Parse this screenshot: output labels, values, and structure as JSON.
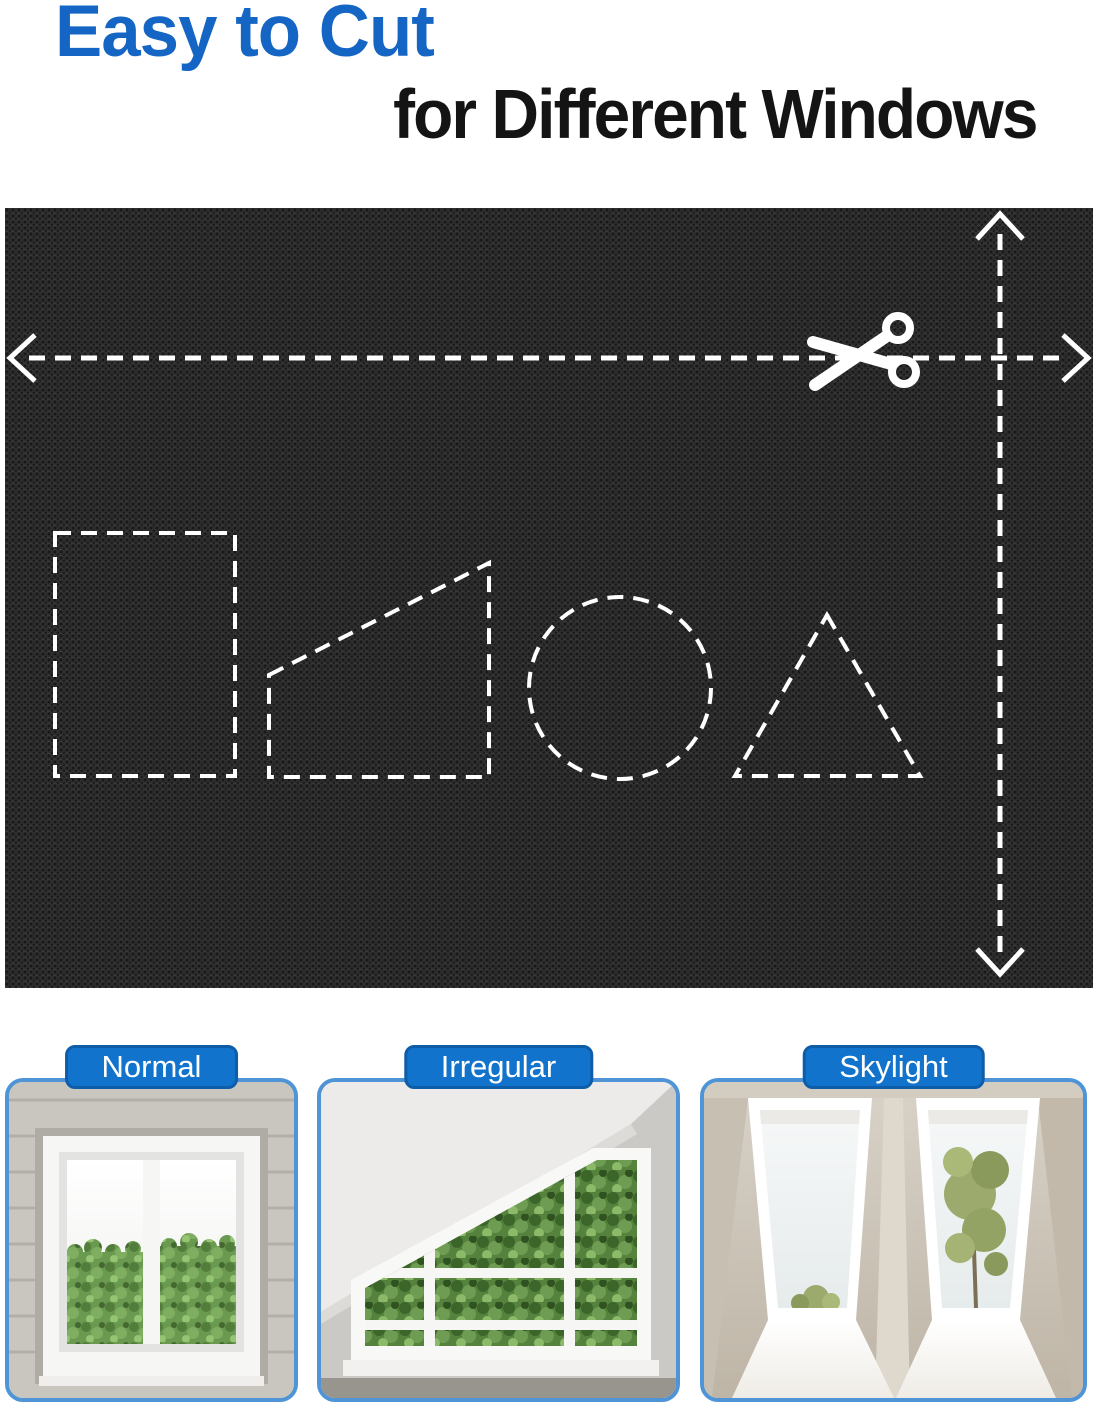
{
  "title": {
    "line1": "Easy to Cut",
    "line2": "for Different Windows"
  },
  "colors": {
    "title_blue": "#1566c4",
    "title_black": "#141414",
    "badge_blue": "#1273cd",
    "badge_border_blue": "#0d5da9",
    "card_border_blue": "#4e94d6",
    "fabric_dark": "#2e2e2e",
    "guide_white": "#ffffff"
  },
  "fabric_panel": {
    "icon": "scissors-icon",
    "guide_arrows": [
      "horizontal-double-arrow",
      "vertical-double-arrow"
    ],
    "cut_shapes": [
      "rectangle",
      "trapezoid",
      "circle",
      "triangle"
    ]
  },
  "cards": [
    {
      "label": "Normal"
    },
    {
      "label": "Irregular"
    },
    {
      "label": "Skylight"
    }
  ]
}
